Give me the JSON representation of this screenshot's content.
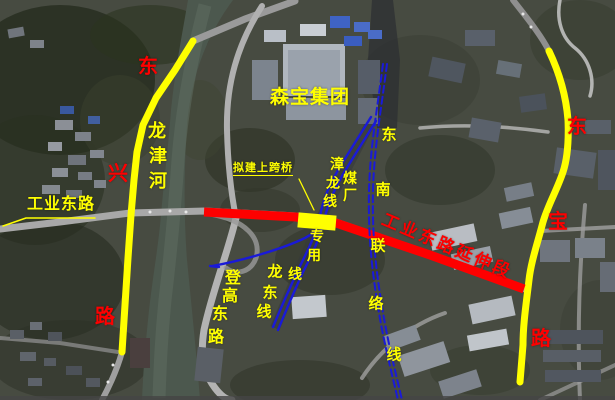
{
  "map": {
    "colors": {
      "highlight_yellow": "#ffff00",
      "highlight_red": "#fe0000",
      "rail_blue": "#1a1ad8"
    },
    "labels": {
      "industrial_east_road": {
        "text": "工业东路"
      },
      "extension_section": {
        "text": "工业东路延伸段"
      },
      "senbao_group": {
        "text": "森宝集团"
      },
      "proposed_overpass": {
        "text": "拟建上跨桥"
      },
      "longjin_river": {
        "chars": [
          "龙",
          "津",
          "河"
        ]
      },
      "zhanglong_line": {
        "chars": [
          "漳",
          "龙",
          "线"
        ]
      },
      "coal_plant_line": {
        "chars": [
          "煤",
          "厂",
          "专",
          "用",
          "线"
        ]
      },
      "southeast_link_line": {
        "chars": [
          "东",
          "南",
          "联",
          "络",
          "线"
        ]
      },
      "longdong_line": {
        "chars": [
          "龙",
          "东",
          "线"
        ]
      },
      "denggao_east_road": {
        "chars": [
          "登",
          "高",
          "东",
          "路"
        ]
      },
      "dongxing_road": {
        "chars": [
          "东",
          "兴",
          "路"
        ]
      },
      "dongbao_road": {
        "chars": [
          "东",
          "宝",
          "路"
        ]
      }
    }
  }
}
